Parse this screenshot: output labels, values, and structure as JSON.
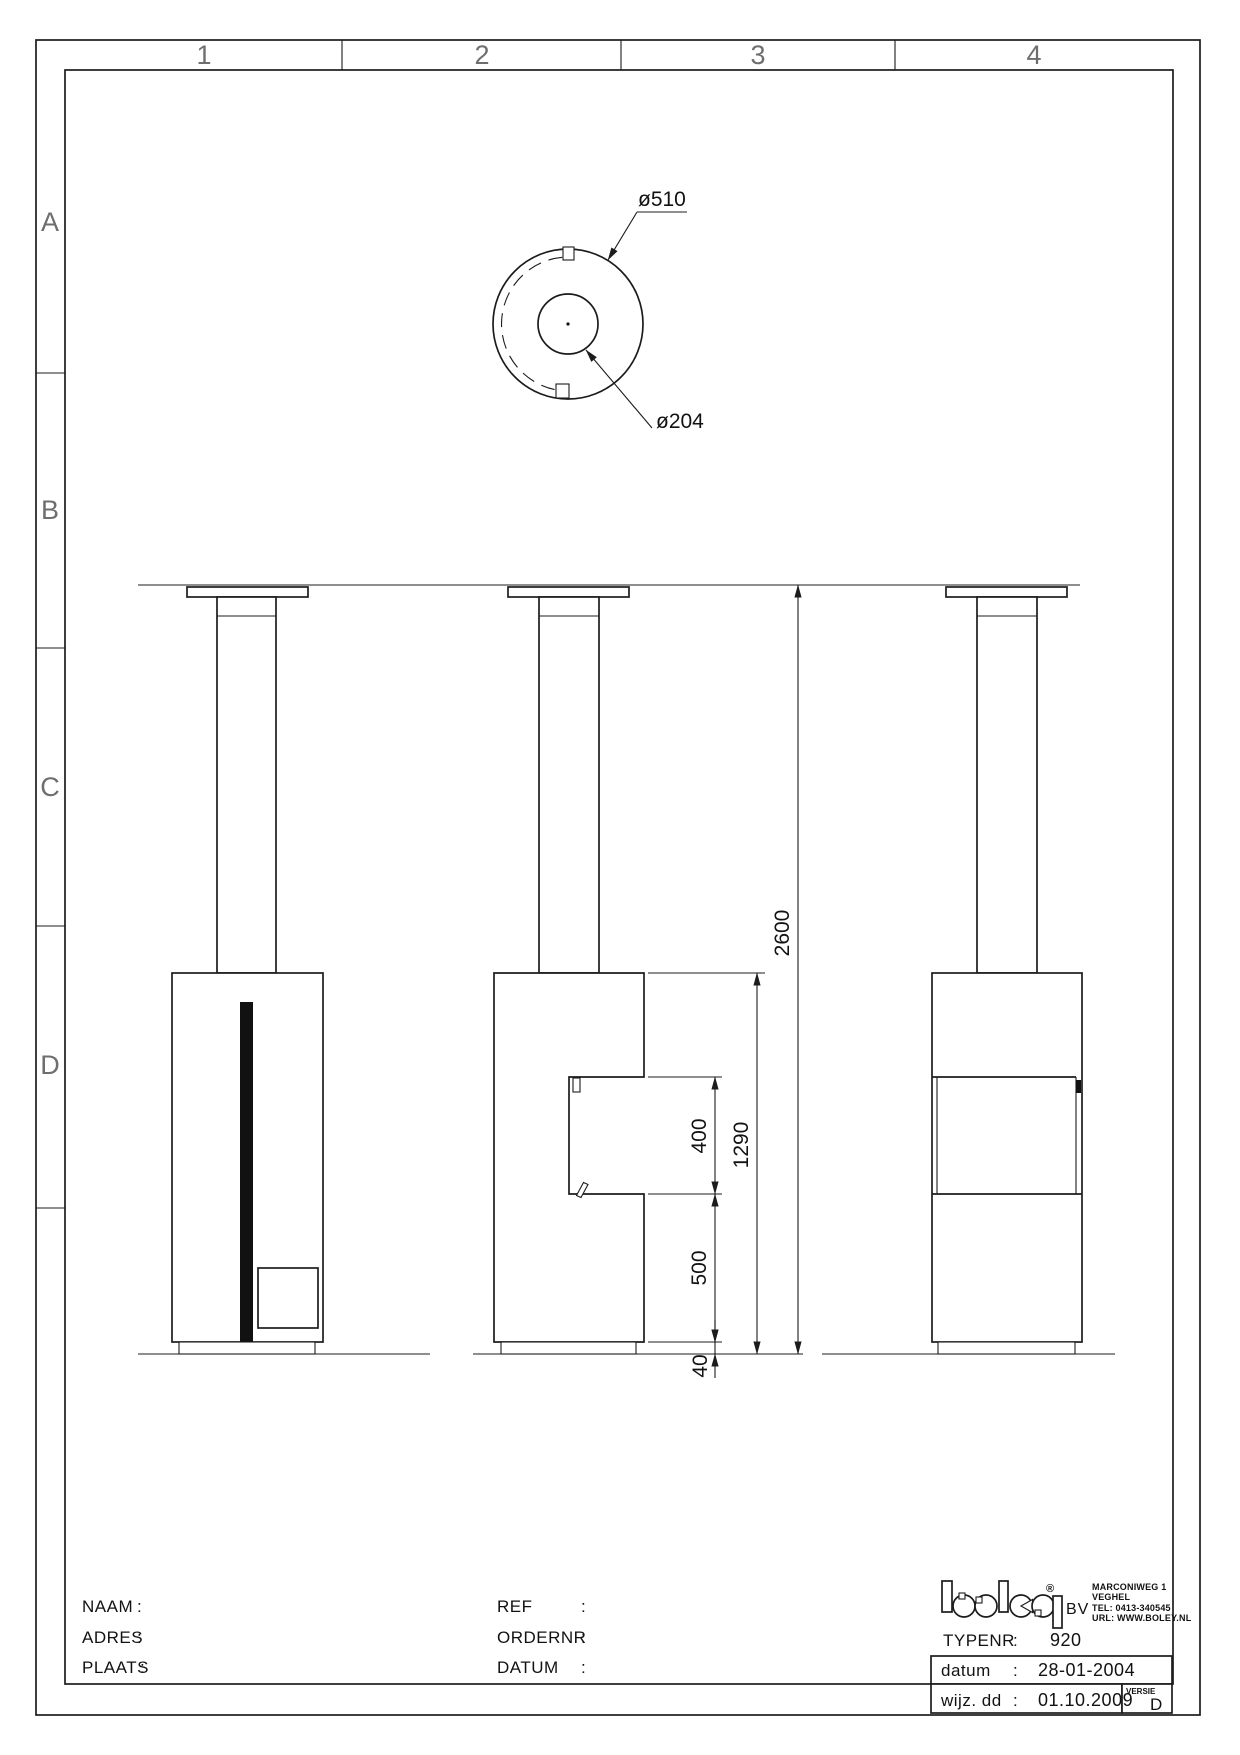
{
  "sheet": {
    "grid_columns": [
      "1",
      "2",
      "3",
      "4"
    ],
    "grid_rows": [
      "A",
      "B",
      "C",
      "D"
    ]
  },
  "top_view": {
    "outer_dia_label": "ø510",
    "inner_dia_label": "ø204"
  },
  "dims": {
    "duct_height": "2600",
    "stove_height": "1290",
    "door_opening": "400",
    "lower_body": "500",
    "plinth": "40"
  },
  "title_block": {
    "customer": {
      "naam": "NAAM",
      "adres": "ADRES",
      "plaats": "PLAATS",
      "colon": ":"
    },
    "order": {
      "ref": "REF",
      "ordernr": "ORDERNR",
      "datum": "DATUM",
      "colon": ":"
    },
    "brand": {
      "name": "boley",
      "registered": "®",
      "suffix": "BV",
      "address_lines": [
        "MARCONIWEG 1",
        "VEGHEL",
        "TEL:  0413-340545",
        "URL:  WWW.BOLEY.NL"
      ]
    },
    "type_row": {
      "label": "TYPENR",
      "colon": ":",
      "value": "920"
    },
    "date_row": {
      "label": "datum",
      "colon": ":",
      "value": "28-01-2004"
    },
    "rev_row": {
      "label": "wijz. dd",
      "colon": ":",
      "value": "01.10.2009"
    },
    "versie": {
      "label": "VERSIE",
      "value": "D"
    }
  }
}
